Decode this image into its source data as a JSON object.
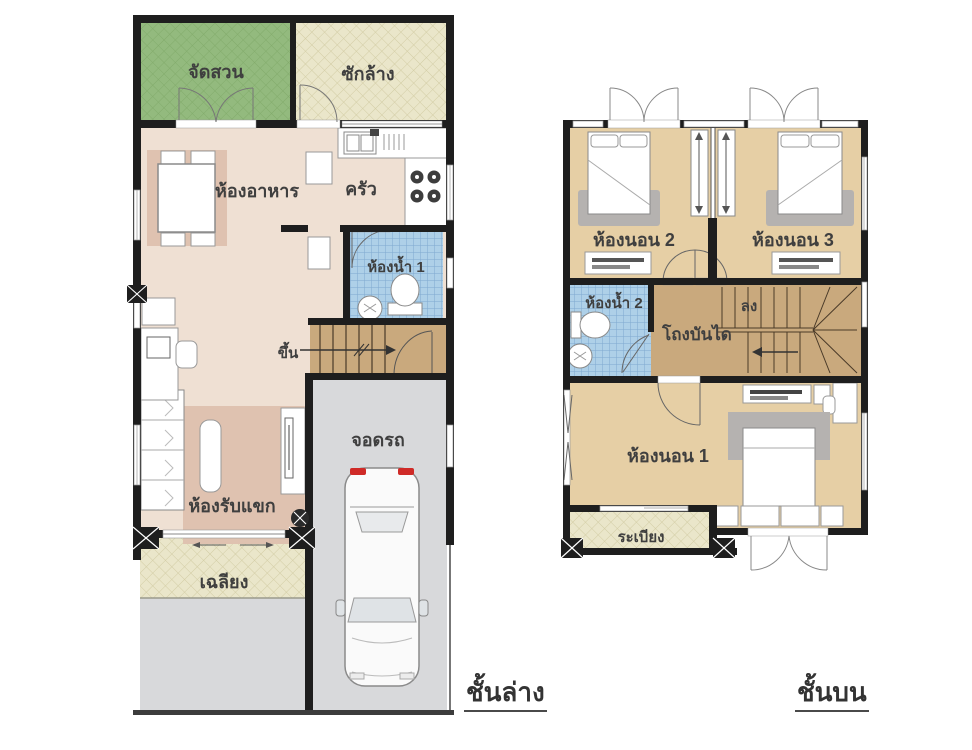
{
  "captions": {
    "ground": "ชั้นล่าง",
    "upper": "ชั้นบน"
  },
  "ground_floor": {
    "garden": "จัดสวน",
    "laundry": "ซักล้าง",
    "dining": "ห้องอาหาร",
    "kitchen": "ครัว",
    "bathroom1": "ห้องน้ำ 1",
    "up": "ขึ้น",
    "living": "ห้องรับแขก",
    "carport": "จอดรถ",
    "porch": "เฉลียง"
  },
  "upper_floor": {
    "bedroom2": "ห้องนอน 2",
    "bedroom3": "ห้องนอน 3",
    "bathroom2": "ห้องน้ำ 2",
    "stair_hall": "โถงบันได",
    "down": "ลง",
    "bedroom1": "ห้องนอน 1",
    "balcony": "ระเบียง"
  },
  "colors": {
    "wall": "#1e1e1e",
    "interior_floor": "#efe0d3",
    "garden_green": "#93ba7e",
    "service_beige": "#eae6ca",
    "bathroom_blue": "#aed0e8",
    "stair_brown": "#c9a97d",
    "bedroom_tan": "#e6cfa5",
    "garage_gray": "#d8d9db",
    "rug_pink": "#dfc2b0",
    "furniture_gray": "#b5b2b0",
    "tail_light_red": "#cf2a27",
    "label_text": "#3f3f3f"
  }
}
